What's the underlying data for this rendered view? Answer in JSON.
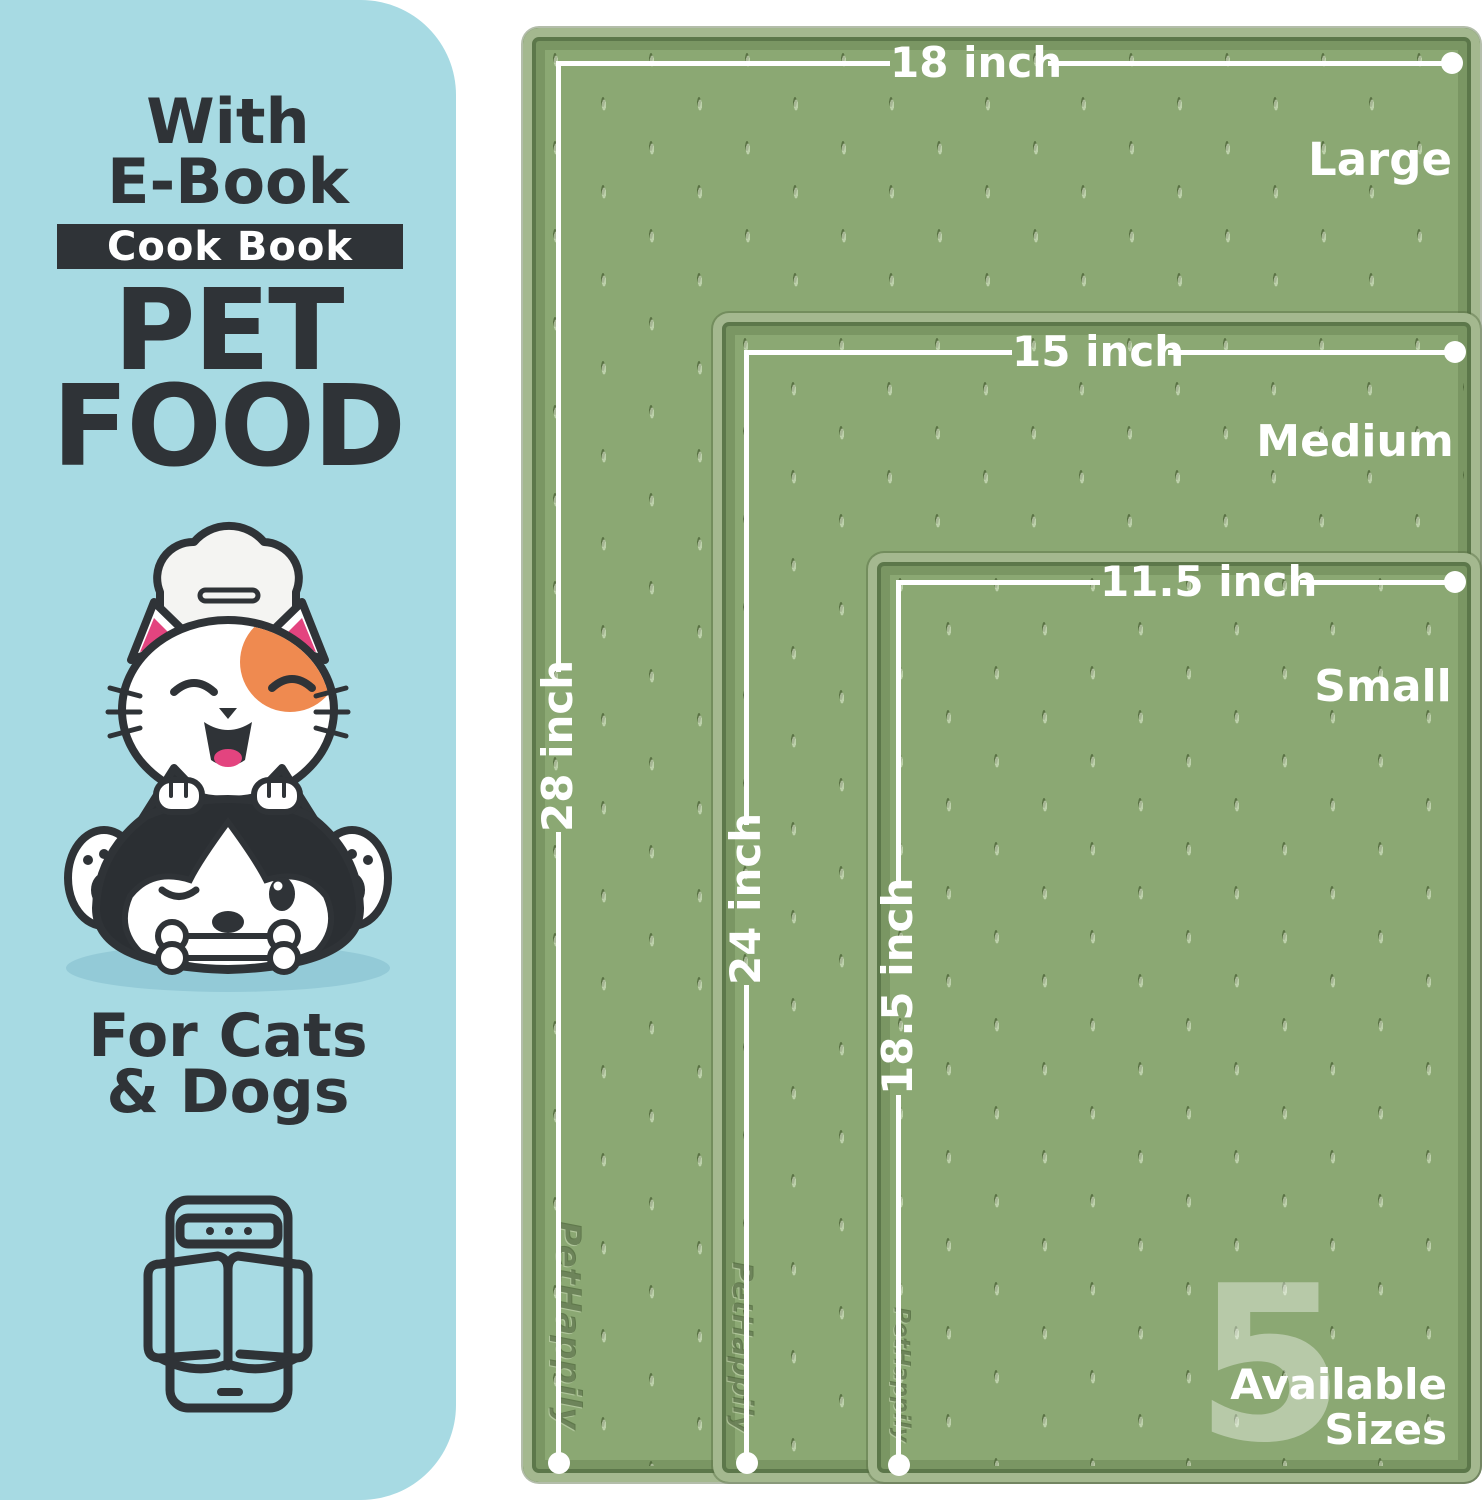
{
  "panel": {
    "bg_color": "#A7DAE3",
    "text_color": "#2F3337",
    "header_line1": "With",
    "header_line2": "E-Book",
    "badge": "Cook Book",
    "title_line1": "PET",
    "title_line2": "FOOD",
    "subtitle_line1": "For Cats",
    "subtitle_line2": "& Dogs",
    "illustration": "chef-cat-on-husky-dog-with-bone",
    "icon": "ebook-tablet-open-book-icon"
  },
  "mats": {
    "surface_color": "#8BA873",
    "rim_color": "#A4B88F",
    "groove_color": "#5C774A",
    "line_color": "#FFFFFF",
    "brand_emboss": "PetHappily",
    "items": [
      {
        "size": "Large",
        "width_label": "18 inch",
        "height_label": "28 inch"
      },
      {
        "size": "Medium",
        "width_label": "15 inch",
        "height_label": "24 inch"
      },
      {
        "size": "Small",
        "width_label": "11.5 inch",
        "height_label": "18.5 inch"
      }
    ]
  },
  "availability": {
    "count": "5",
    "word1": "Available",
    "word2": "Sizes"
  }
}
